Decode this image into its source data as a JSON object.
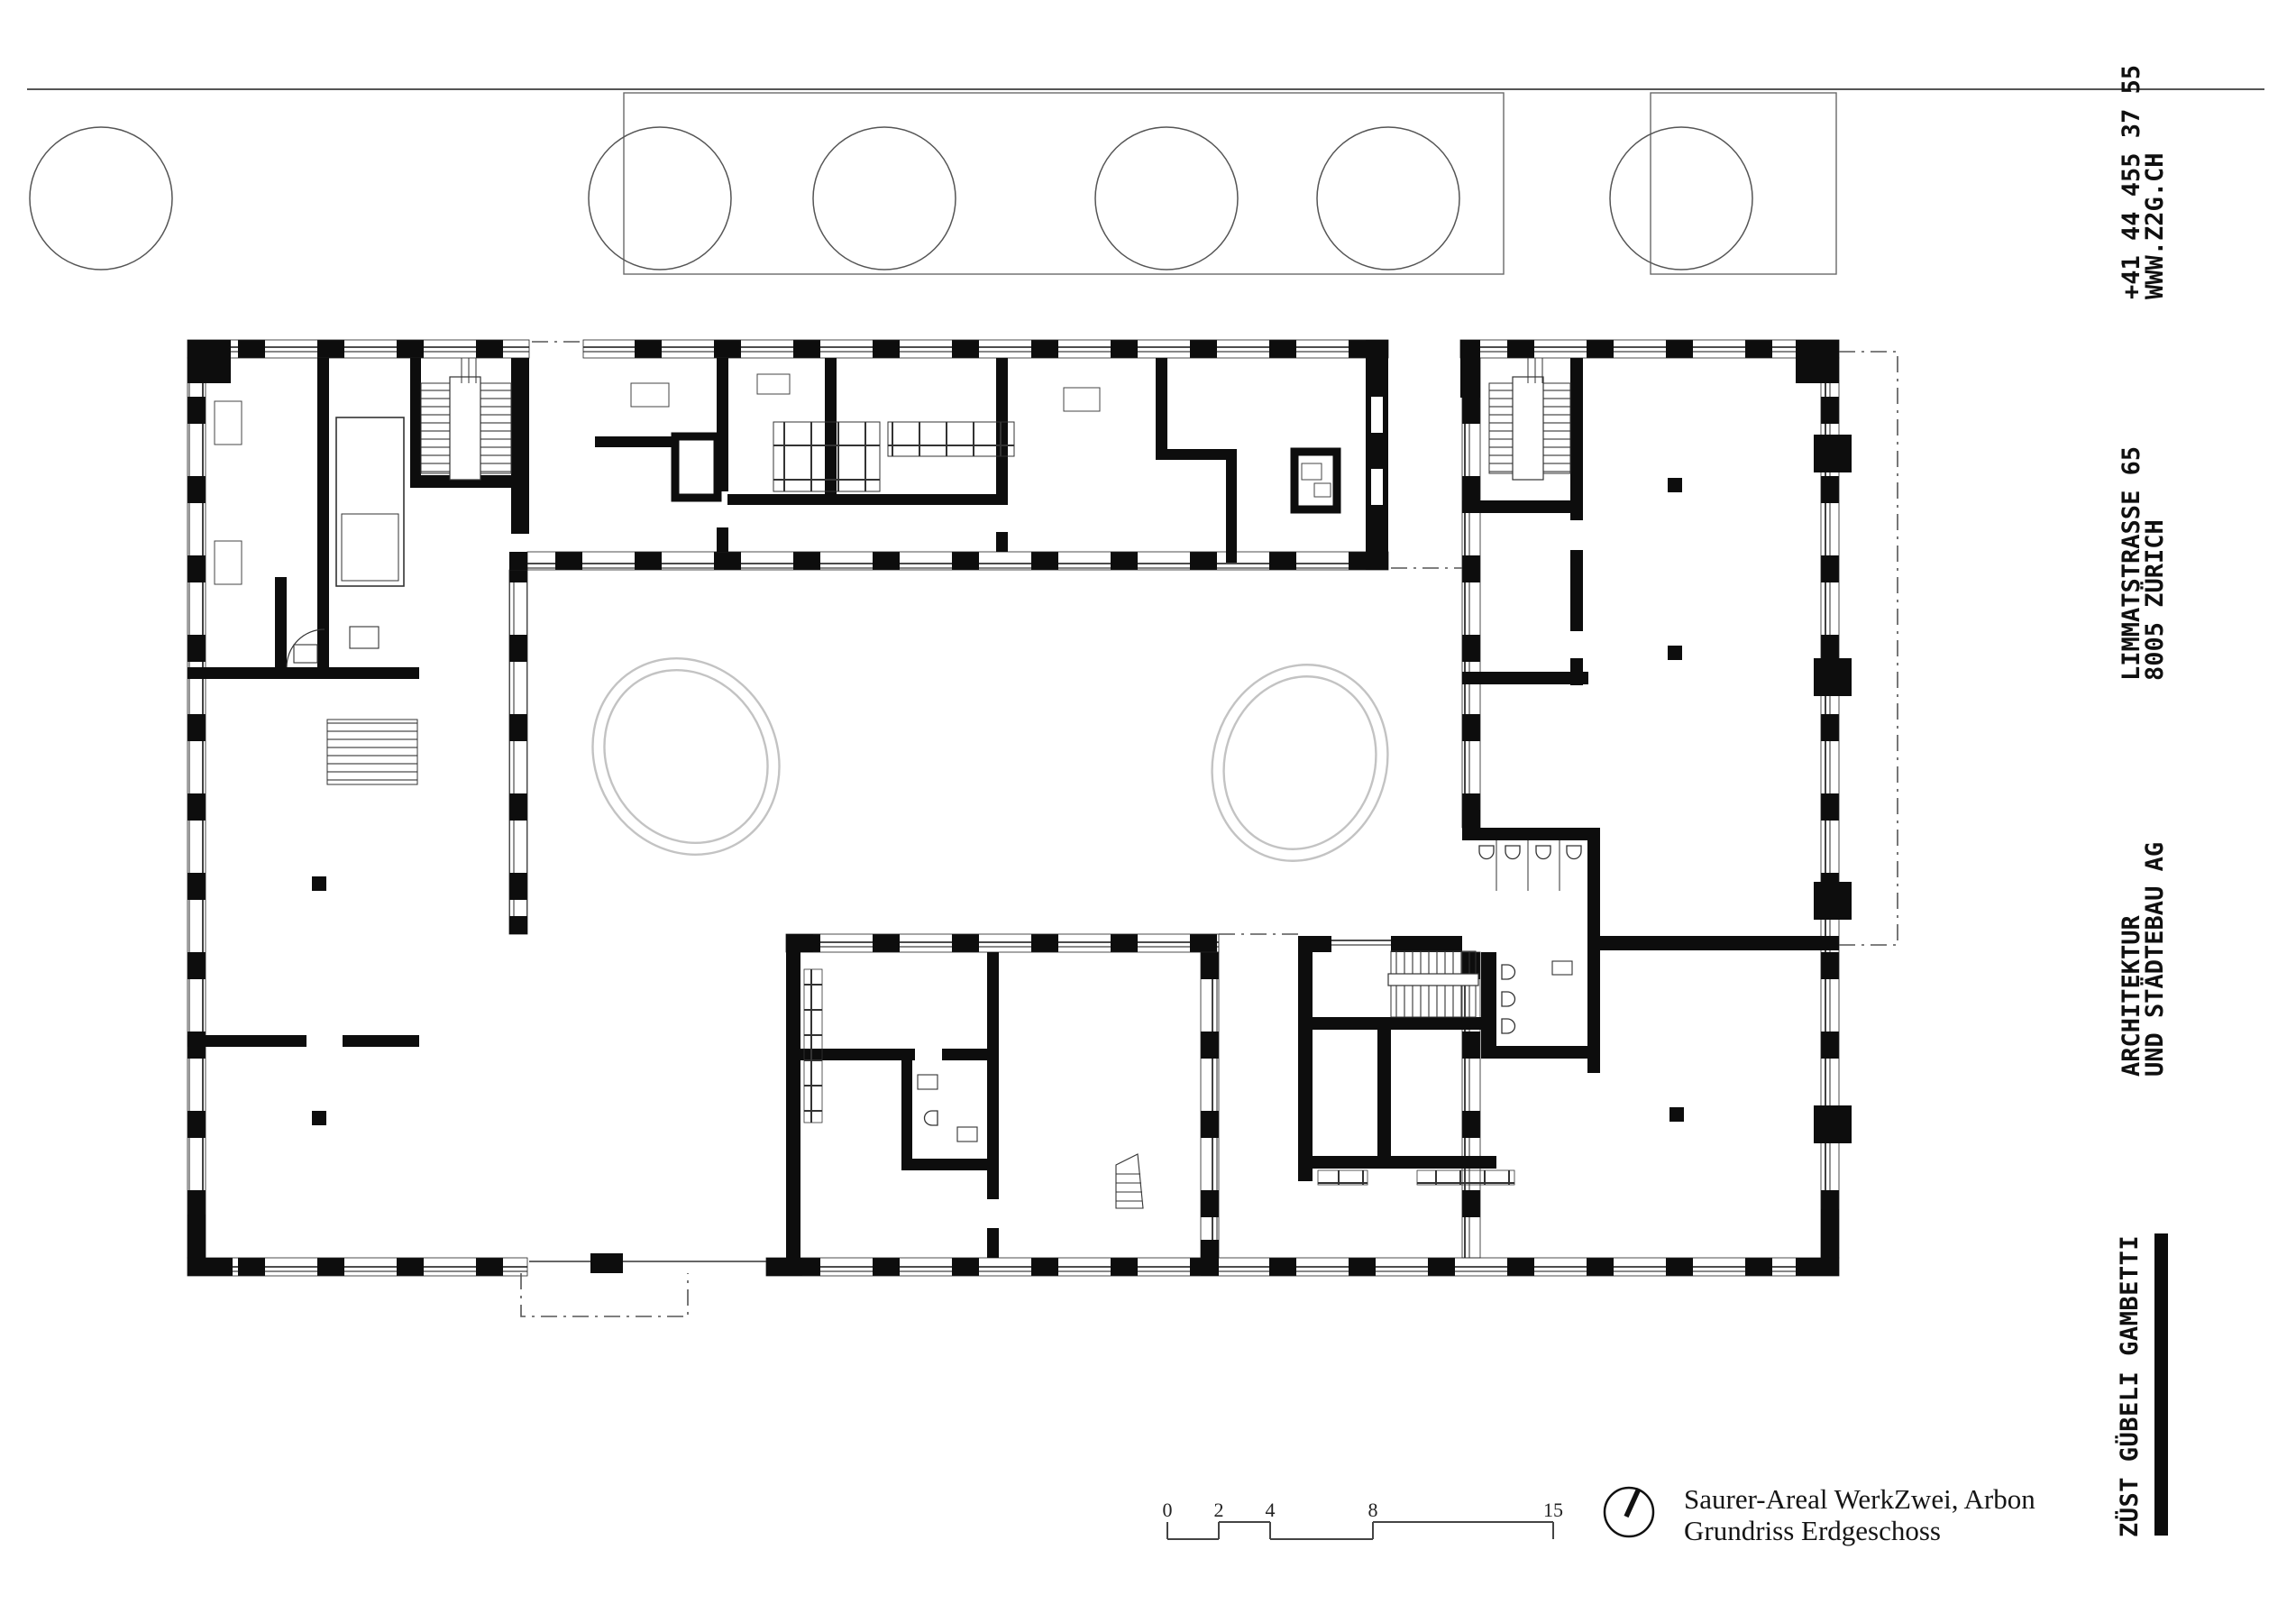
{
  "colors": {
    "ink": "#111111",
    "wall": "#0d0d0d",
    "thin_line": "#3a3a3a",
    "site_line": "#5a5a5a",
    "oval_gray": "#c3c3c3"
  },
  "contact_column": {
    "phone": "+41 44 455 37 55",
    "web": "WWW.Z2G.CH",
    "street": "LIMMATSTRASSE 65",
    "city": "8005 ZÜRICH",
    "firm_line1": "ARCHITEKTUR",
    "firm_line2": "UND STÄDTEBAU AG",
    "brand": "ZÜST GÜBELI GAMBETTI"
  },
  "title_block": {
    "line1": "Saurer-Areal WerkZwei, Arbon",
    "line2": "Grundriss Erdgeschoss"
  },
  "scale_bar": {
    "labels": [
      "0",
      "2",
      "4",
      "8",
      "15"
    ]
  }
}
